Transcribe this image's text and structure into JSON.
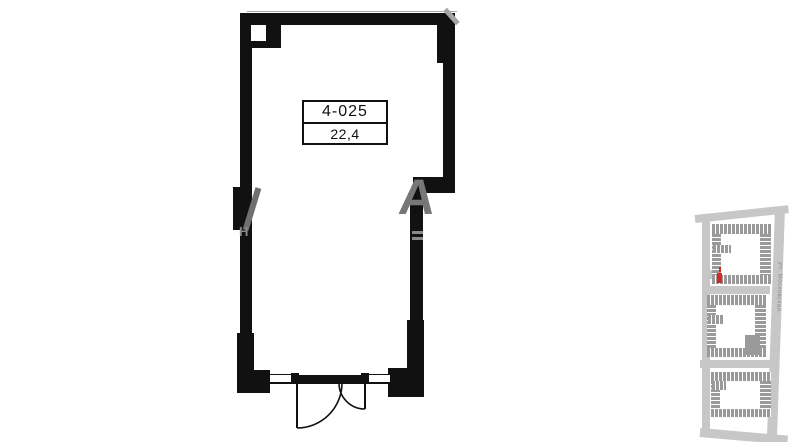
{
  "floor_plan": {
    "unit_label": "4-025",
    "area_label": "22,4",
    "wall_color": "#111111",
    "door_type": "double-swing-entry",
    "watermark": {
      "letter_right": "А",
      "letter_left_small": "Н",
      "color": "#777777"
    }
  },
  "minimap": {
    "street_label": "ул. Московская",
    "road_color": "#c7c7c7",
    "building_color": "#9a9a9a",
    "highlight_color": "#d6291f"
  }
}
